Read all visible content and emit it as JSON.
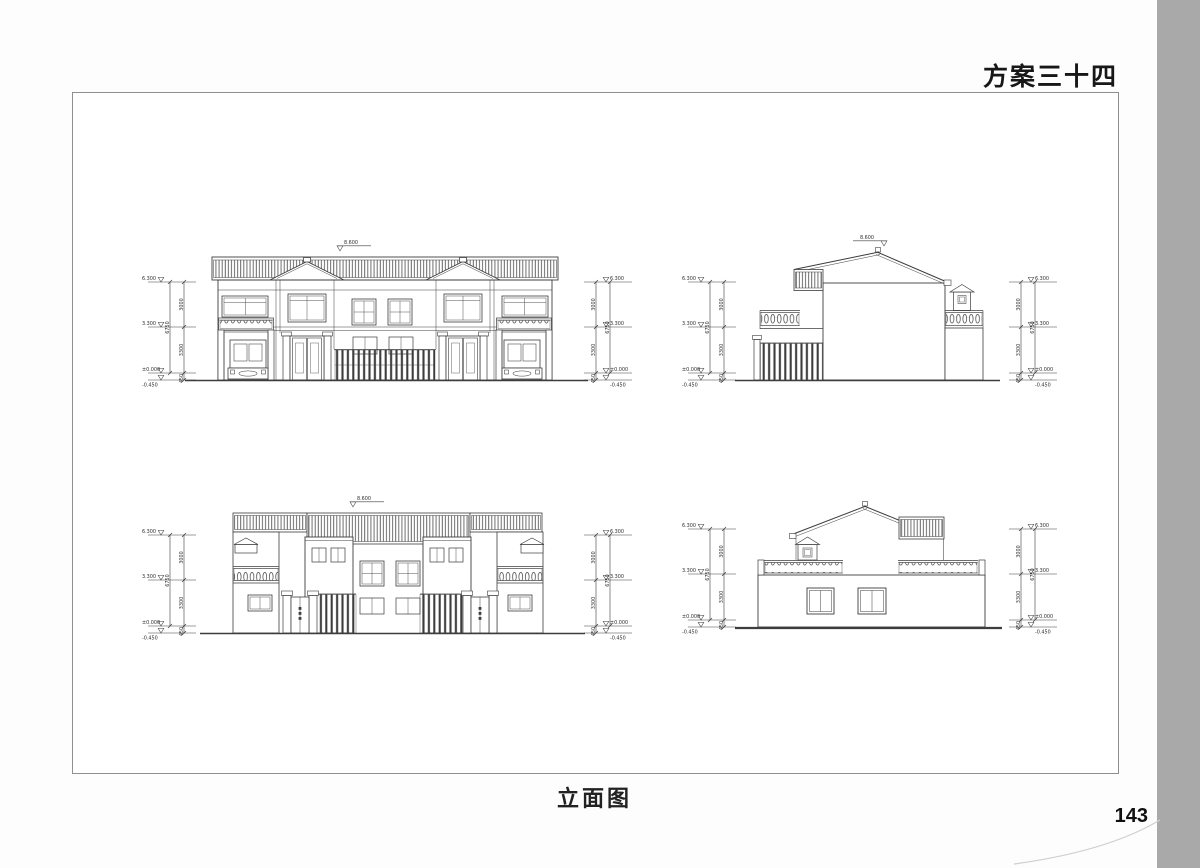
{
  "page": {
    "title": "方案三十四",
    "caption": "立面图",
    "page_number": "143"
  },
  "annotations": {
    "peak_level": "8.600",
    "levels": {
      "top": "6.300",
      "mid": "3.300",
      "zero": "±0.000",
      "below": "-0.450"
    },
    "dims": {
      "upper": "3000",
      "lower": "3300",
      "plinth": "450",
      "total": "6750"
    }
  }
}
